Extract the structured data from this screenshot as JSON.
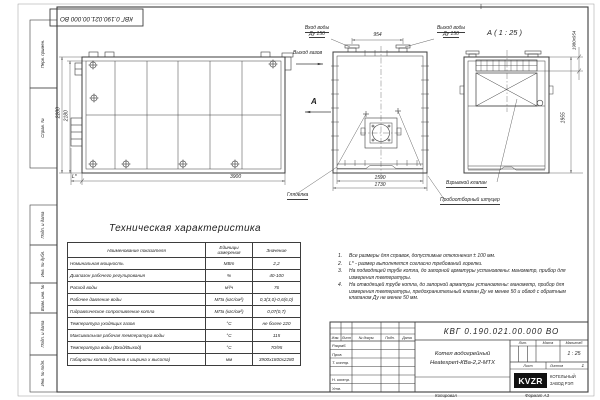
{
  "stamp_box_number": "КВГ 0.190.021.00.000 ВО",
  "margin": {
    "first_use": "Перв. примен.",
    "ref_no": "Справ. №",
    "sign_date1": "Подп. и дата",
    "inv_dup": "Инв. № дубл.",
    "repl_inv": "Взам. инв. №",
    "sign_date2": "Подп. и дата",
    "inv_orig": "Инв. № подл."
  },
  "views": {
    "side": {
      "dim_height_outer": "2280",
      "dim_height_inner": "2180",
      "dim_length": "3900",
      "dim_l": "L*"
    },
    "front": {
      "inlet_line1": "Вход воды",
      "inlet_line2": "Ду 150",
      "outlet_line1": "Выход воды",
      "outlet_line2": "Ду 150",
      "gas_outlet": "Выход газов",
      "view_letter": "А",
      "dim_top": "954",
      "dim_inner": "1590",
      "dim_outer": "1730",
      "sight_glass": "Гляделка",
      "sampling": "Пробоотборный штуцер"
    },
    "section": {
      "title": "А ( 1 : 25 )",
      "dim_wxh": "1980х954",
      "dim_height": "1955",
      "explosion_valve": "Взрывной клапан"
    }
  },
  "table": {
    "title": "Техническая характеристика",
    "headers": [
      "Наименование показателя",
      "Единицы измерения",
      "Значение"
    ],
    "rows": [
      [
        "Номинальная мощность",
        "МВт",
        "2,2"
      ],
      [
        "Диапазон рабочего регулирования",
        "%",
        "40-100"
      ],
      [
        "Расход воды",
        "м³/ч",
        "76"
      ],
      [
        "Рабочее давление воды",
        "МПа (кгс/см²)",
        "0,3(3,0)-0,6(6,0)"
      ],
      [
        "Гидравлическое сопротивление котла",
        "МПа (кгс/см²)",
        "0,07(0,7)"
      ],
      [
        "Температура уходящих газов",
        "°С",
        "не более 220"
      ],
      [
        "Максимальная рабочая температура воды",
        "°С",
        "115"
      ],
      [
        "Температура воды (Вход/Выход)",
        "°С",
        "70/95"
      ],
      [
        "Габариты котла (длинна х ширина х высота)",
        "мм",
        "3900х1800х2280"
      ]
    ]
  },
  "notes": [
    {
      "n": "1.",
      "text": "Все размеры для справок, допустимые отклонения ± 100 мм."
    },
    {
      "n": "2.",
      "text": "L* - размер выполняется согласно требований горелки."
    },
    {
      "n": "3.",
      "text": "На подводящей трубе котла, до запорной арматуры установлены: манометр, прибор для измерения температуры."
    },
    {
      "n": "4.",
      "text": "На отводящей трубе котла, до запорной арматуры установлены: манометр, прибор для измерения температуры, предохранительный клапан Ду не менее 50 и обвод с обратным клапаном Ду не менее 50 мм."
    }
  ],
  "title_block": {
    "doc_number": "КВГ 0.190.021.00.000 ВО",
    "product_line1": "Котел водогрейный",
    "product_line2": "Heatexpert-КВа-2,2-МТХ",
    "header": {
      "izm": "Изм.",
      "list": "Лист",
      "doc": "№ докум.",
      "sign": "Подп.",
      "date": "Дата"
    },
    "rows": {
      "dev": "Разраб.",
      "check": "Пров.",
      "tcontr": "Т. контр.",
      "ncontr": "Н. контр.",
      "approve": "Утв."
    },
    "lit_label": "Лит.",
    "mass_label": "Масса",
    "scale_label": "Масштаб",
    "scale_value": "1 : 25",
    "sheet_label": "Лист",
    "sheets_label": "Листов",
    "sheets_value": "1",
    "logo_text": "KVZR",
    "company_line1": "КОТЕЛЬНЫЙ",
    "company_line2": "ЗАВОД РЭП",
    "copied_label": "Копировал",
    "format_label": "Формат А3"
  }
}
